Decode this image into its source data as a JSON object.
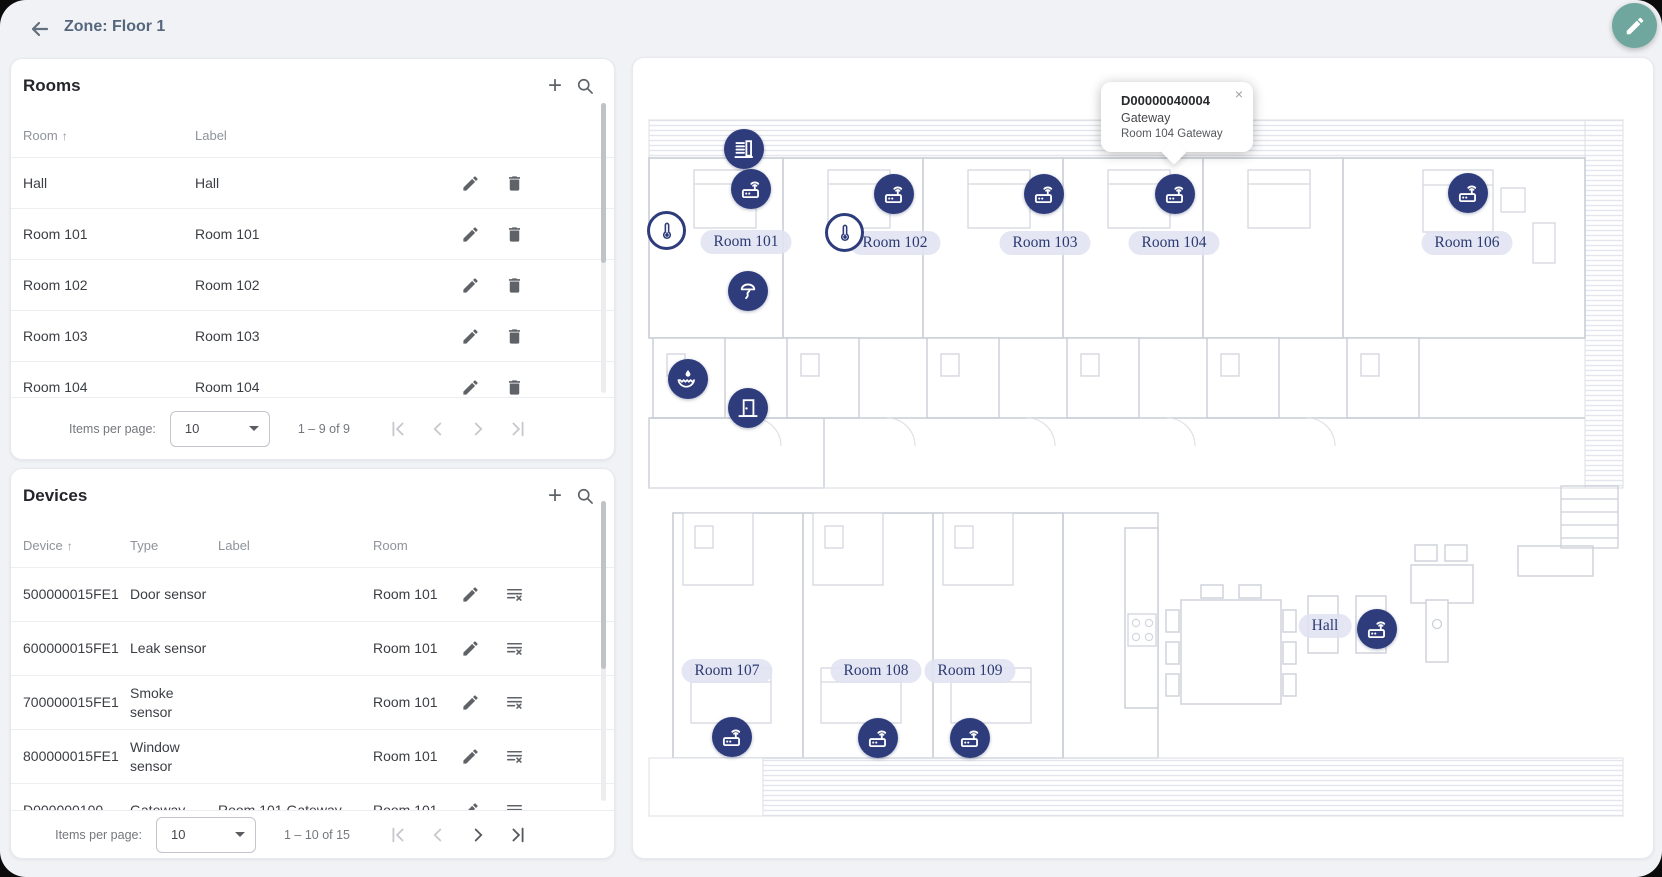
{
  "header": {
    "title": "Zone: Floor 1"
  },
  "icons": {
    "plus": "+",
    "sort_asc": "↑",
    "close": "×"
  },
  "colors": {
    "accent_teal": "#6fa79f",
    "marker_navy": "#2e3c7c",
    "pill_bg": "#e0e3f1",
    "pill_text": "#2c3a72"
  },
  "rooms": {
    "title": "Rooms",
    "columns": {
      "room": "Room",
      "label": "Label"
    },
    "rows": [
      {
        "room": "Hall",
        "label": "Hall"
      },
      {
        "room": "Room 101",
        "label": "Room 101"
      },
      {
        "room": "Room 102",
        "label": "Room 102"
      },
      {
        "room": "Room 103",
        "label": "Room 103"
      },
      {
        "room": "Room 104",
        "label": "Room 104"
      }
    ],
    "paginator": {
      "items_per_page_label": "Items per page:",
      "page_size": "10",
      "range": "1 – 9 of 9"
    }
  },
  "devices": {
    "title": "Devices",
    "columns": {
      "device": "Device",
      "type": "Type",
      "label": "Label",
      "room": "Room"
    },
    "rows": [
      {
        "device": "500000015FE1",
        "type": "Door sensor",
        "label": "",
        "room": "Room 101"
      },
      {
        "device": "600000015FE1",
        "type": "Leak sensor",
        "label": "",
        "room": "Room 101"
      },
      {
        "device": "700000015FE1",
        "type": "Smoke sensor",
        "label": "",
        "room": "Room 101"
      },
      {
        "device": "800000015FE1",
        "type": "Window sensor",
        "label": "",
        "room": "Room 101"
      },
      {
        "device": "D000000100",
        "type": "Gateway",
        "label": "Room 101 Gateway",
        "room": "Room 101"
      }
    ],
    "paginator": {
      "items_per_page_label": "Items per page:",
      "page_size": "10",
      "range": "1 – 10 of 15"
    }
  },
  "floorplan": {
    "tooltip": {
      "device_id": "D00000040004",
      "device_type": "Gateway",
      "device_label": "Room 104 Gateway"
    },
    "labels": {
      "room101": "Room 101",
      "room102": "Room 102",
      "room103": "Room 103",
      "room104": "Room 104",
      "room106": "Room 106",
      "room107": "Room 107",
      "room108": "Room 108",
      "room109": "Room 109",
      "hall": "Hall"
    }
  }
}
